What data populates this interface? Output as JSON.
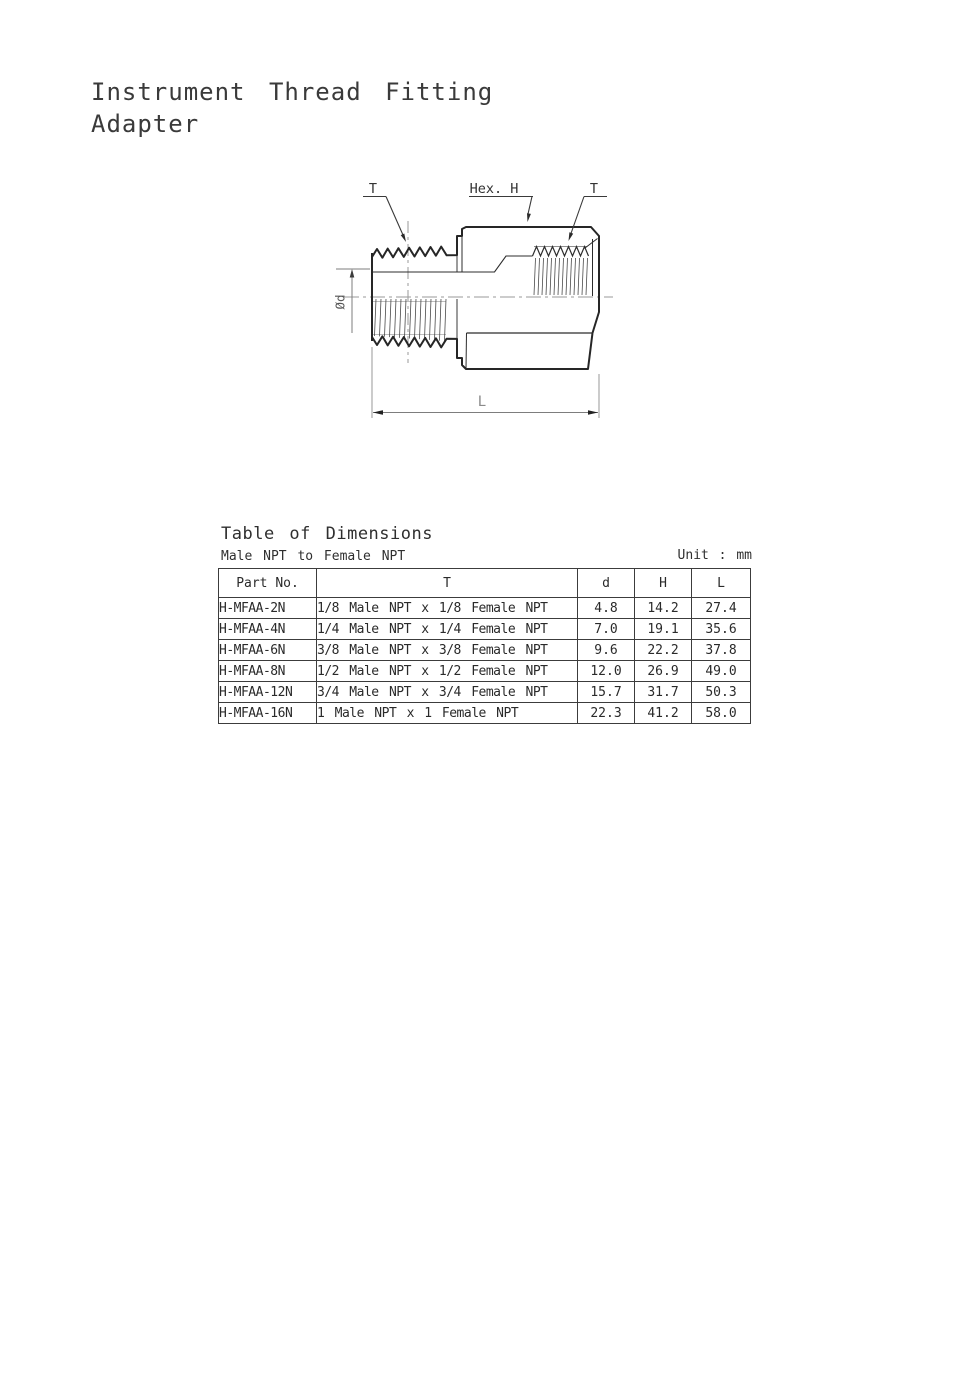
{
  "header": {
    "title_line1": "Instrument Thread Fitting",
    "title_line2": "Adapter"
  },
  "drawing": {
    "labels": {
      "male_thread": "T",
      "hex": "Hex. H",
      "female_thread": "T",
      "diameter": "Ød",
      "length": "L"
    }
  },
  "table": {
    "title": "Table of Dimensions",
    "subtitle": "Male NPT to Female NPT",
    "unit_note": "Unit : mm",
    "columns": [
      "Part No.",
      "T",
      "d",
      "H",
      "L"
    ],
    "rows": [
      [
        "H-MFAA-2N",
        "1/8 Male NPT x 1/8 Female NPT",
        "4.8",
        "14.2",
        "27.4"
      ],
      [
        "H-MFAA-4N",
        "1/4 Male NPT x 1/4 Female NPT",
        "7.0",
        "19.1",
        "35.6"
      ],
      [
        "H-MFAA-6N",
        "3/8 Male NPT x 3/8 Female NPT",
        "9.6",
        "22.2",
        "37.8"
      ],
      [
        "H-MFAA-8N",
        "1/2 Male NPT x 1/2 Female NPT",
        "12.0",
        "26.9",
        "49.0"
      ],
      [
        "H-MFAA-12N",
        "3/4 Male NPT x 3/4 Female NPT",
        "15.7",
        "31.7",
        "50.3"
      ],
      [
        "H-MFAA-16N",
        "1 Male NPT x 1 Female NPT",
        "22.3",
        "41.2",
        "58.0"
      ]
    ]
  },
  "colors": {
    "outline": "#262626",
    "dimension_line": "#7d7d7d",
    "centerline": "#9a9a9a",
    "text": "#333333",
    "background": "#ffffff"
  }
}
